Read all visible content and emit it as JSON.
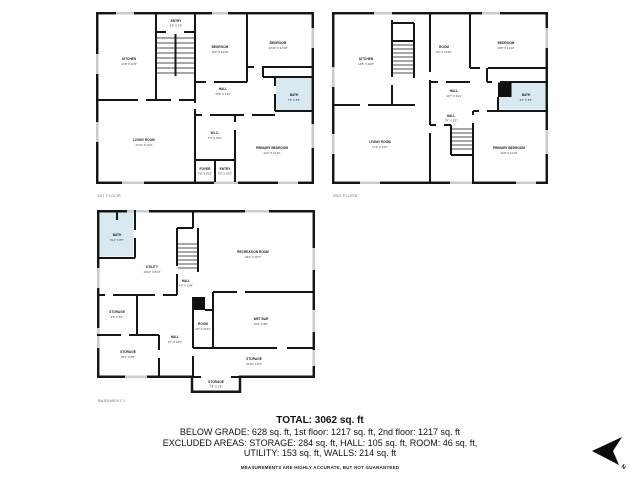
{
  "floors": [
    {
      "label": "1ST FLOOR",
      "rooms": [
        {
          "name": "ENTRY",
          "dims": "8'8\" X 3'9\""
        },
        {
          "name": "KITCHEN",
          "dims": "14'8\" X 11'6\""
        },
        {
          "name": "BEDROOM",
          "dims": "12'2\" X 12'10\""
        },
        {
          "name": "BEDROOM",
          "dims": "10'10\" X 12'10\""
        },
        {
          "name": "BATH",
          "dims": "7'6\" X 8'5\""
        },
        {
          "name": "HALL",
          "dims": "10'8\" X 4'11\""
        },
        {
          "name": "LIVING ROOM",
          "dims": "17'11\" X 14'2\""
        },
        {
          "name": "W.I.C.",
          "dims": "7'4\" X 3'10\""
        },
        {
          "name": "PRIMARY BEDROOM",
          "dims": "12'2\" X 12'10\""
        },
        {
          "name": "FOYER",
          "dims": "3'6\" X 6'10\""
        },
        {
          "name": "ENTRY",
          "dims": "3'6\" X 6'10\""
        }
      ]
    },
    {
      "label": "2ND FLOOR",
      "rooms": [
        {
          "name": "KITCHEN",
          "dims": "14'8\" X 10'8\""
        },
        {
          "name": "ROOM",
          "dims": "9'1\" X 12'10\""
        },
        {
          "name": "BEDROOM",
          "dims": "10'8\" X 12'10\""
        },
        {
          "name": "HALL",
          "dims": "10'7\" X 6'11\""
        },
        {
          "name": "BATH",
          "dims": "9'5\" X 8'5\""
        },
        {
          "name": "LIVING ROOM",
          "dims": "17'1\" X 14'2\""
        },
        {
          "name": "HALL",
          "dims": "7'4\" X 5'3\""
        },
        {
          "name": "PRIMARY BEDROOM",
          "dims": "12'9\" X 12'10\""
        }
      ]
    },
    {
      "label": "BASEMENT 1",
      "rooms": [
        {
          "name": "BATH",
          "dims": "5'11\" X 8'5\""
        },
        {
          "name": "UTILITY",
          "dims": "13'10\" X 8'10\""
        },
        {
          "name": "RECREATION ROOM",
          "dims": "20'4\" X 15'7\""
        },
        {
          "name": "HALL",
          "dims": "4'6\" X 15'8\""
        },
        {
          "name": "STORAGE",
          "dims": "5'8\" X 6'5\""
        },
        {
          "name": "STORAGE",
          "dims": "8'11\" X 8'8\""
        },
        {
          "name": "HALL",
          "dims": "4'7\" X 10'5\""
        },
        {
          "name": "ROOM",
          "dims": "4'2\" X 10'11\""
        },
        {
          "name": "WET BAR",
          "dims": "10'2\" X 8'8\""
        },
        {
          "name": "STORAGE",
          "dims": "20'10\" X 8'7\""
        },
        {
          "name": "STORAGE",
          "dims": "7'8\" X 2'8\""
        }
      ]
    }
  ],
  "summary": {
    "total": "TOTAL: 3062 sq. ft",
    "line1": "BELOW GRADE: 628 sq. ft, 1st floor: 1217 sq. ft, 2nd floor: 1217 sq. ft",
    "line2": "EXCLUDED AREAS: STORAGE: 284 sq. ft, HALL: 105 sq. ft, ROOM: 46 sq. ft,",
    "line3": "UTILITY: 153 sq. ft, WALLS: 214 sq. ft",
    "disclaimer": "MEASUREMENTS ARE HIGHLY ACCURATE, BUT NOT GUARANTEED"
  },
  "compass": {
    "label": "N"
  },
  "colors": {
    "wall": "#161616",
    "bath_fill": "#d8e9f2",
    "window": "#c7ccd0",
    "chimney": "#101010"
  }
}
